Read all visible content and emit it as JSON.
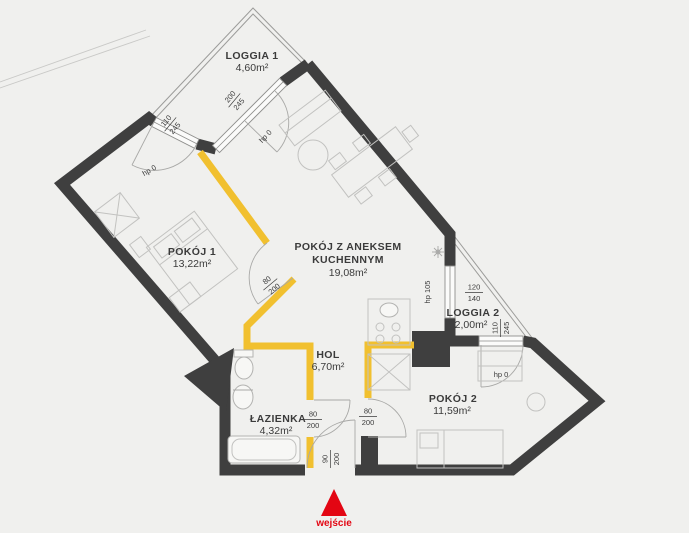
{
  "colors": {
    "bg": "#f0f0ee",
    "wall": "#3f3f3f",
    "accent": "#f1c02f",
    "entry": "#e30613"
  },
  "rooms": {
    "loggia1": {
      "name": "LOGGIA 1",
      "area": "4,60m²"
    },
    "pokoj1": {
      "name": "POKÓJ 1",
      "area": "13,22m²"
    },
    "salon": {
      "name1": "POKÓJ Z ANEKSEM",
      "name2": "KUCHENNYM",
      "area": "19,08m²"
    },
    "hol": {
      "name": "HOL",
      "area": "6,70m²"
    },
    "lazienka": {
      "name": "ŁAZIENKA",
      "area": "4,32m²"
    },
    "pokoj2": {
      "name": "POKÓJ 2",
      "area": "11,59m²"
    },
    "loggia2": {
      "name": "LOGGIA 2",
      "area": "2,00m²"
    }
  },
  "openings": {
    "loggia1_window": {
      "w": "200",
      "h": "245",
      "sill": "hp 0"
    },
    "pokoj1_balcony_door": {
      "w": "110",
      "h": "245",
      "sill": "hp 0"
    },
    "kitchen_window": {
      "w": "120",
      "h": "140",
      "sill": "hp 105"
    },
    "pokoj2_balcony_door": {
      "w": "110",
      "h": "245",
      "sill": "hp 0"
    },
    "pokoj1_door": {
      "w": "80",
      "h": "200"
    },
    "lazienka_door": {
      "w": "80",
      "h": "200"
    },
    "pokoj2_door": {
      "w": "80",
      "h": "200"
    },
    "entrance_door": {
      "w": "90",
      "h": "200"
    }
  },
  "entrance": {
    "label": "wejście"
  }
}
